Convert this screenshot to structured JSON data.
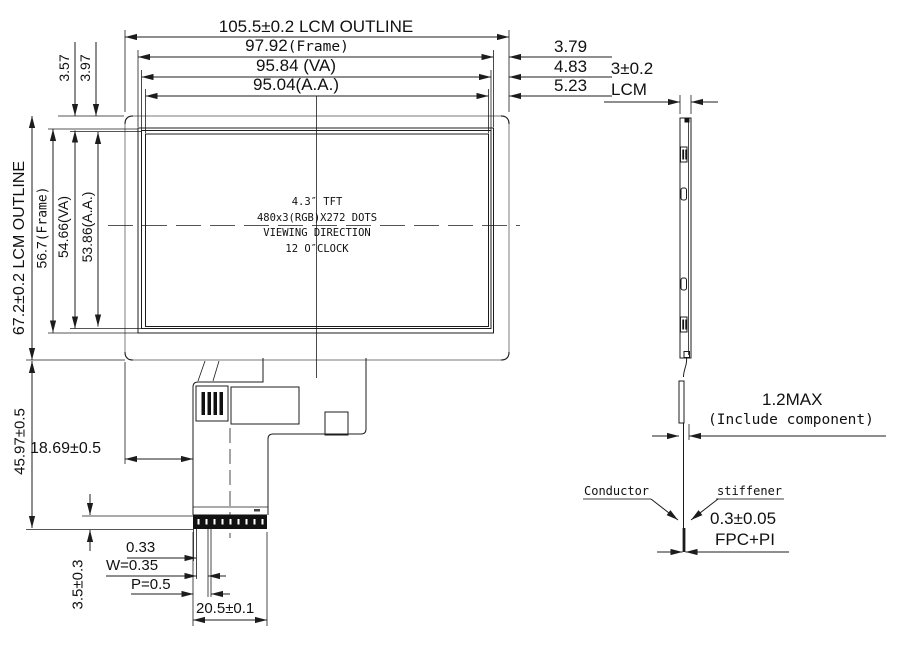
{
  "front": {
    "dim_top_lcm": "105.5±0.2 LCM OUTLINE",
    "dim_top_frame_num": "97.92",
    "dim_top_frame_suffix": "(Frame)",
    "dim_top_va": "95.84 (VA)",
    "dim_top_aa": "95.04(A.A.)",
    "dim_right_1": "3.79",
    "dim_right_2": "4.83",
    "dim_right_3": "5.23",
    "dim_left_lcm": "67.2±0.2 LCM OUTLINE",
    "dim_left_frame_num": "56.7",
    "dim_left_frame_suffix": "(Frame)",
    "dim_left_va": "54.66(VA)",
    "dim_left_aa": "53.86(A.A.)",
    "dim_left_top1": "3.57",
    "dim_left_top2": "3.97",
    "panel_text_1": "4.3″ TFT",
    "panel_text_2": "480x3(RGB)X272 DOTS",
    "panel_text_3": "VIEWING DIRECTION",
    "panel_text_4": "12 O″CLOCK",
    "dim_fpc_length": "45.97±0.5",
    "dim_fpc_offset": "18.69±0.5",
    "dim_pin_gap": "0.33",
    "dim_pin_width": "W=0.35",
    "dim_pin_pitch": "P=0.5",
    "dim_connector_width": "20.5±0.1",
    "dim_stiffener_height": "3.5±0.3"
  },
  "side": {
    "dim_thickness_num": "3±0.2",
    "dim_thickness_label": "LCM",
    "dim_component_max": "1.2MAX",
    "dim_component_note": "(Include component)",
    "label_conductor": "Conductor",
    "label_stiffener": "stiffener",
    "dim_fpc_thickness": "0.3±0.05",
    "label_fpc_material": "FPC+PI"
  }
}
